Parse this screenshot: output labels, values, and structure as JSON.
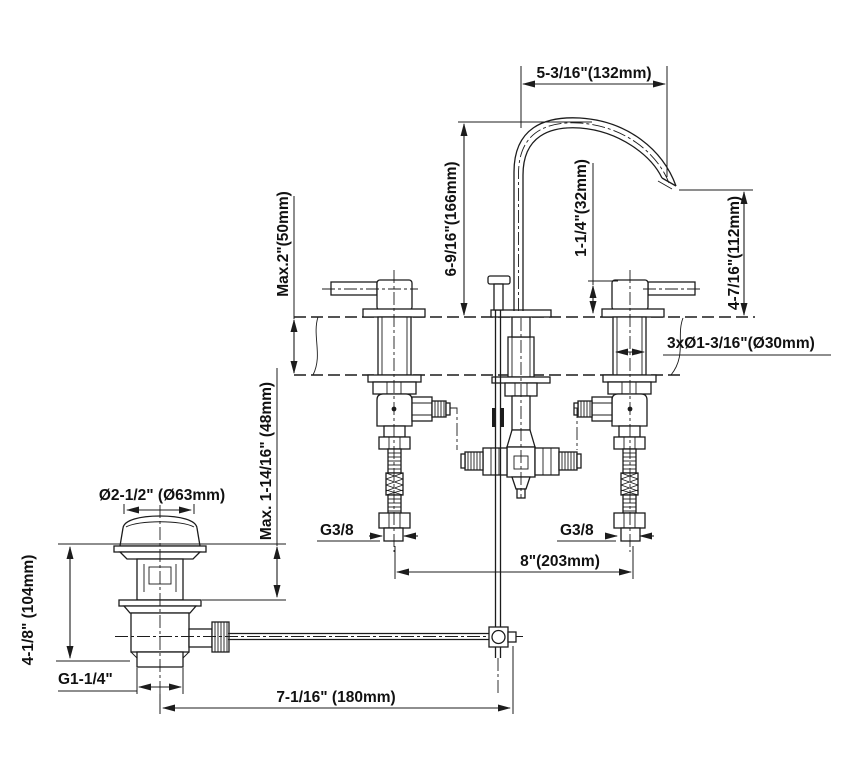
{
  "drawing": {
    "subject": "3-hole widespread basin faucet with pop-up drain, dimensioned technical drawing",
    "line_color": "#1c1c1c",
    "background_color": "#ffffff",
    "dimensions": {
      "spout_reach": "5-3/16\"(132mm)",
      "spout_height": "6-9/16\"(166mm)",
      "handle_height": "1-1/4\"(32mm)",
      "outlet_height": "4-7/16\"(112mm)",
      "max_deck_thickness": "Max.2\"(50mm)",
      "max_drain_deck_thickness": "Max. 1-14/16\" (48mm)",
      "mounting_holes": "3xØ1-3/16\"(Ø30mm)",
      "drain_flange_diameter": "Ø2-1/2\" (Ø63mm)",
      "drain_height": "4-1/8\" (104mm)",
      "drain_thread": "G1-1/4\"",
      "supply_thread_left": "G3/8",
      "supply_thread_right": "G3/8",
      "hole_spacing": "8\"(203mm)",
      "rod_reach": "7-1/16\" (180mm)"
    }
  }
}
